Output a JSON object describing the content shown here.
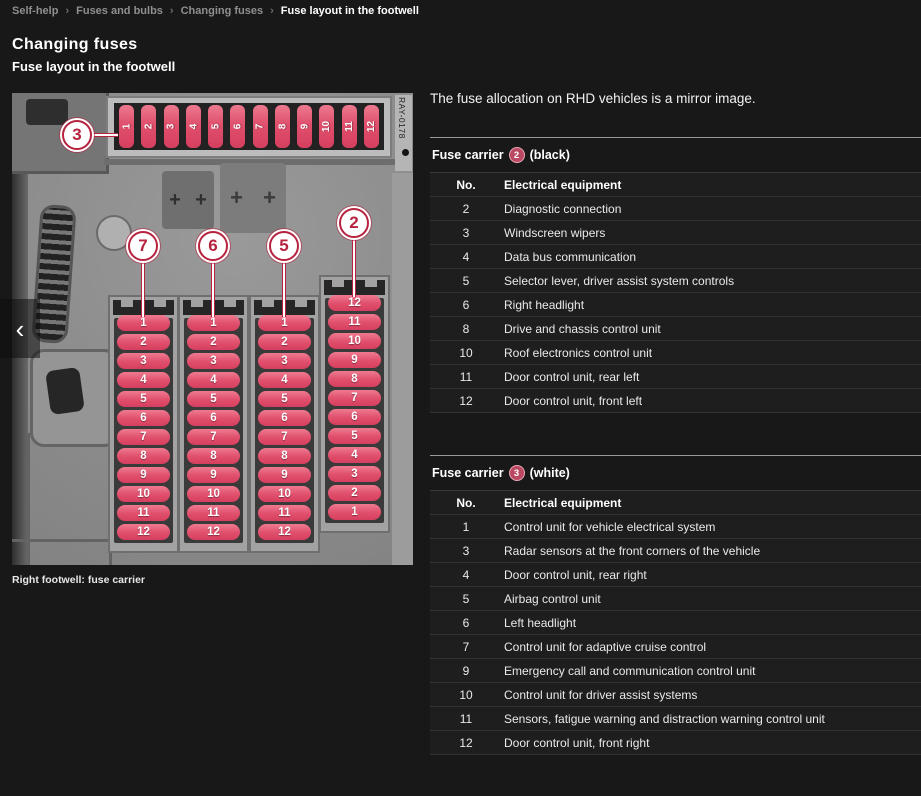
{
  "breadcrumb": {
    "separator": "›",
    "items": [
      {
        "label": "Self-help"
      },
      {
        "label": "Fuses and bulbs"
      },
      {
        "label": "Changing fuses"
      },
      {
        "label": "Fuse layout in the footwell"
      }
    ]
  },
  "page": {
    "title": "Changing fuses",
    "subtitle": "Fuse layout in the footwell",
    "intro": "The fuse allocation on RHD vehicles is a mirror image."
  },
  "figure": {
    "caption": "Right footwell: fuse carrier",
    "ref_code": "RAY-0178",
    "carousel": {
      "prev": "‹"
    },
    "top_strip": {
      "callout": "3",
      "fuses": [
        "1",
        "2",
        "3",
        "4",
        "5",
        "6",
        "7",
        "8",
        "9",
        "10",
        "11",
        "12"
      ]
    },
    "columns": [
      {
        "callout": "7",
        "fuses": [
          "1",
          "2",
          "3",
          "4",
          "5",
          "6",
          "7",
          "8",
          "9",
          "10",
          "11",
          "12"
        ]
      },
      {
        "callout": "6",
        "fuses": [
          "1",
          "2",
          "3",
          "4",
          "5",
          "6",
          "7",
          "8",
          "9",
          "10",
          "11",
          "12"
        ]
      },
      {
        "callout": "5",
        "fuses": [
          "1",
          "2",
          "3",
          "4",
          "5",
          "6",
          "7",
          "8",
          "9",
          "10",
          "11",
          "12"
        ]
      },
      {
        "callout": "2",
        "fuses": [
          "12",
          "11",
          "10",
          "9",
          "8",
          "7",
          "6",
          "5",
          "4",
          "3",
          "2",
          "1"
        ]
      }
    ]
  },
  "tables": [
    {
      "title_prefix": "Fuse carrier",
      "callout": "2",
      "title_suffix": "(black)",
      "col_no": "No.",
      "col_equipment": "Electrical equipment",
      "rows": [
        {
          "no": "2",
          "equipment": "Diagnostic connection"
        },
        {
          "no": "3",
          "equipment": "Windscreen wipers"
        },
        {
          "no": "4",
          "equipment": "Data bus communication"
        },
        {
          "no": "5",
          "equipment": "Selector lever, driver assist system controls"
        },
        {
          "no": "6",
          "equipment": "Right headlight"
        },
        {
          "no": "8",
          "equipment": "Drive and chassis control unit"
        },
        {
          "no": "10",
          "equipment": "Roof electronics control unit"
        },
        {
          "no": "11",
          "equipment": "Door control unit, rear left"
        },
        {
          "no": "12",
          "equipment": "Door control unit, front left"
        }
      ]
    },
    {
      "title_prefix": "Fuse carrier",
      "callout": "3",
      "title_suffix": "(white)",
      "col_no": "No.",
      "col_equipment": "Electrical equipment",
      "rows": [
        {
          "no": "1",
          "equipment": "Control unit for vehicle electrical system"
        },
        {
          "no": "3",
          "equipment": "Radar sensors at the front corners of the vehicle"
        },
        {
          "no": "4",
          "equipment": "Door control unit, rear right"
        },
        {
          "no": "5",
          "equipment": "Airbag control unit"
        },
        {
          "no": "6",
          "equipment": "Left headlight"
        },
        {
          "no": "7",
          "equipment": "Control unit for adaptive cruise control"
        },
        {
          "no": "9",
          "equipment": "Emergency call and communication control unit"
        },
        {
          "no": "10",
          "equipment": "Control unit for driver assist systems"
        },
        {
          "no": "11",
          "equipment": "Sensors, fatigue warning and distraction warning control unit"
        },
        {
          "no": "12",
          "equipment": "Door control unit, front right"
        }
      ]
    }
  ],
  "colors": {
    "page_bg": "#181818",
    "fuse_pink": "#e0506d",
    "callout_red": "#b6233f"
  }
}
